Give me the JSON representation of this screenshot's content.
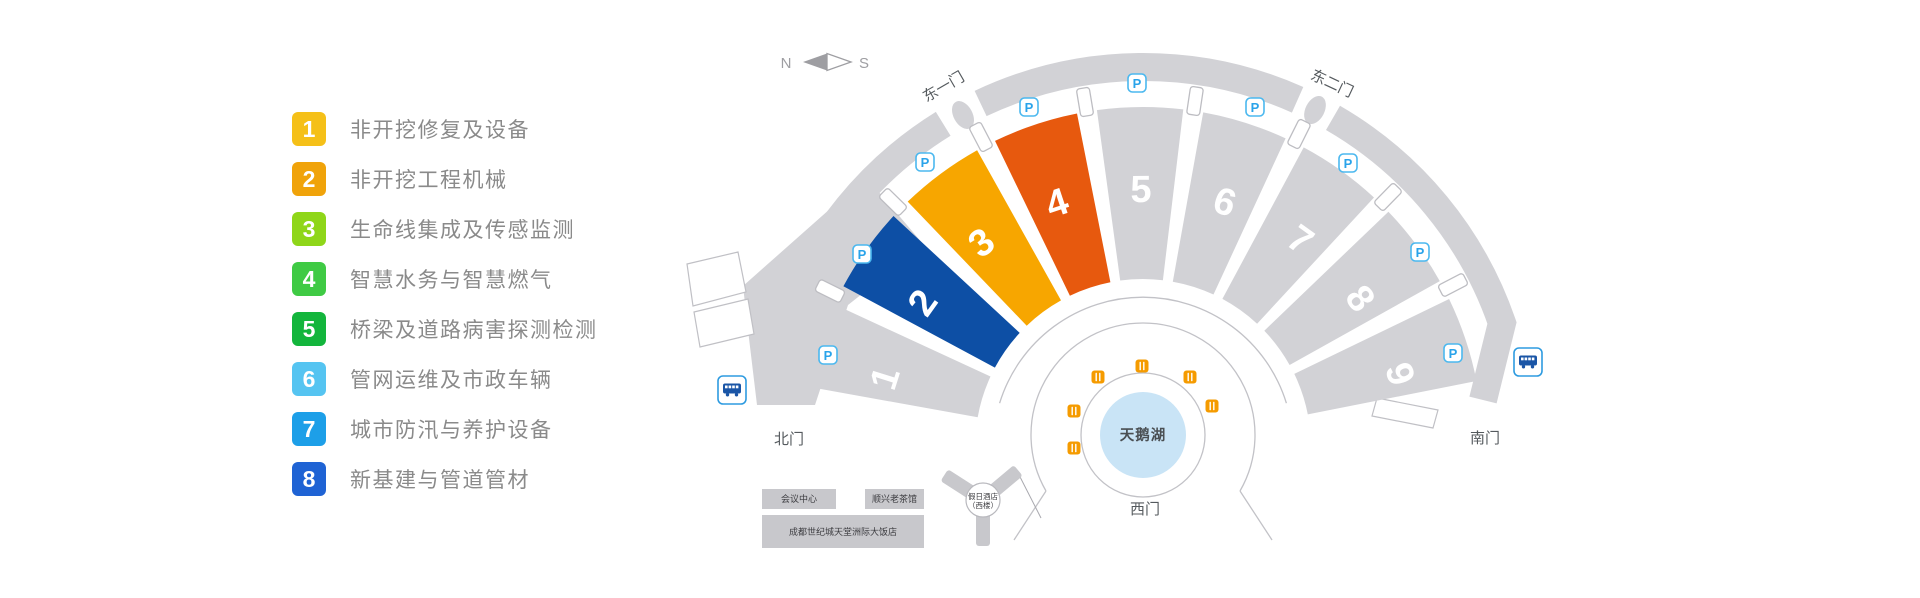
{
  "legend": {
    "items": [
      {
        "number": "1",
        "label": "非开挖修复及设备",
        "color": "#f5c018"
      },
      {
        "number": "2",
        "label": "非开挖工程机械",
        "color": "#f0a30a"
      },
      {
        "number": "3",
        "label": "生命线集成及传感监测",
        "color": "#8fd619"
      },
      {
        "number": "4",
        "label": "智慧水务与智慧燃气",
        "color": "#3fca44"
      },
      {
        "number": "5",
        "label": "桥梁及道路病害探测检测",
        "color": "#13b53c"
      },
      {
        "number": "6",
        "label": "管网运维及市政车辆",
        "color": "#55c4f1"
      },
      {
        "number": "7",
        "label": "城市防汛与养护设备",
        "color": "#1d9fe8"
      },
      {
        "number": "8",
        "label": "新基建与管道管材",
        "color": "#1f63d4"
      }
    ]
  },
  "map": {
    "compass": {
      "north": "N",
      "south": "S"
    },
    "parking_label": "P",
    "gates": {
      "east_gate_1": "东一门",
      "east_gate_2": "东二门",
      "north_gate": "北门",
      "south_gate": "南门",
      "west_gate": "西门"
    },
    "lake": {
      "label": "天鹅湖",
      "color": "#c9e4f6"
    },
    "halls": [
      {
        "number": "1",
        "color": "#d2d2d6"
      },
      {
        "number": "2",
        "color": "#0d4fa5"
      },
      {
        "number": "3",
        "color": "#f7a600"
      },
      {
        "number": "4",
        "color": "#e7590e"
      },
      {
        "number": "5",
        "color": "#d2d2d6"
      },
      {
        "number": "6",
        "color": "#d2d2d6"
      },
      {
        "number": "7",
        "color": "#d2d2d6"
      },
      {
        "number": "8",
        "color": "#d2d2d6"
      },
      {
        "number": "9",
        "color": "#d2d2d6"
      }
    ],
    "buildings": {
      "conference": "会议中心",
      "teahouse": "顺兴老茶馆",
      "intercontinental": "成都世纪城天堂洲际大饭店",
      "holiday_line1": "假日酒店",
      "holiday_line2": "（西楼）"
    },
    "colors": {
      "road_gray": "#d2d2d6",
      "building_gray": "#c8c8cc",
      "parking_border": "#4bb8ef",
      "bus_blue": "#1a55a6",
      "restaurant_orange": "#f59b00"
    }
  }
}
